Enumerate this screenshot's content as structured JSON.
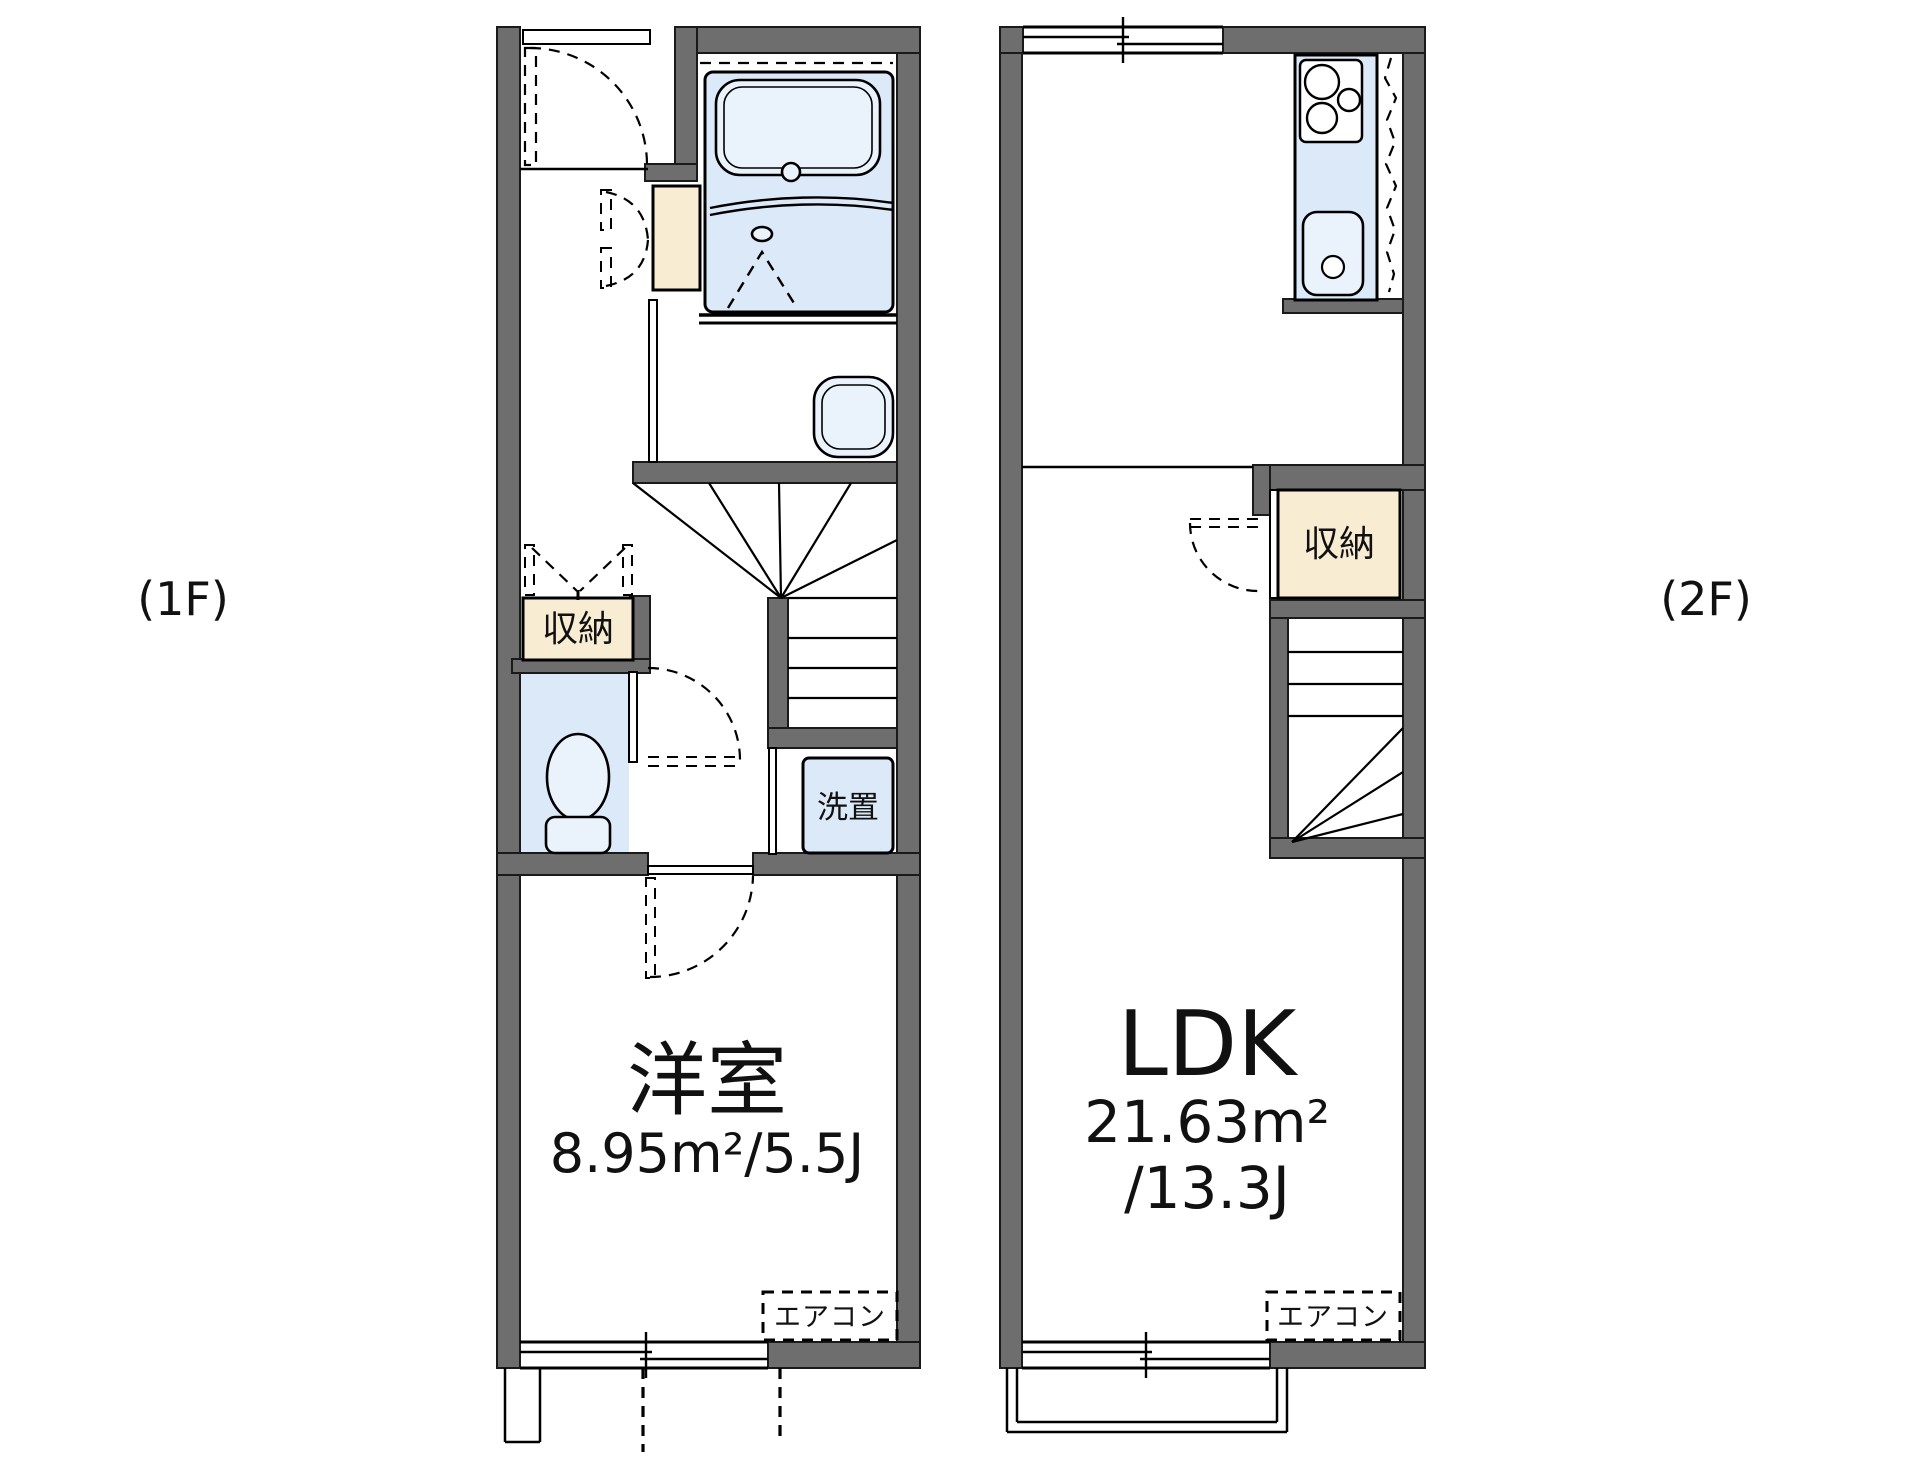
{
  "floor_1f": {
    "floor_label": "(1F)",
    "room_name": "洋室",
    "room_area": "8.95m²/5.5J",
    "closet_label": "収納",
    "laundry_label": "洗置",
    "aircon_label": "エアコン"
  },
  "floor_2f": {
    "floor_label": "(2F)",
    "room_name": "LDK",
    "room_area_sqm": "21.63m²",
    "room_area_jo": "/13.3J",
    "closet_label": "収納",
    "aircon_label": "エアコン"
  },
  "colors": {
    "wall": "#6e6e6e",
    "water": "#dbe9f8",
    "waterlight": "#eaf2fb",
    "cream": "#f8ecd3",
    "ink": "#111111",
    "bg": "#ffffff"
  }
}
